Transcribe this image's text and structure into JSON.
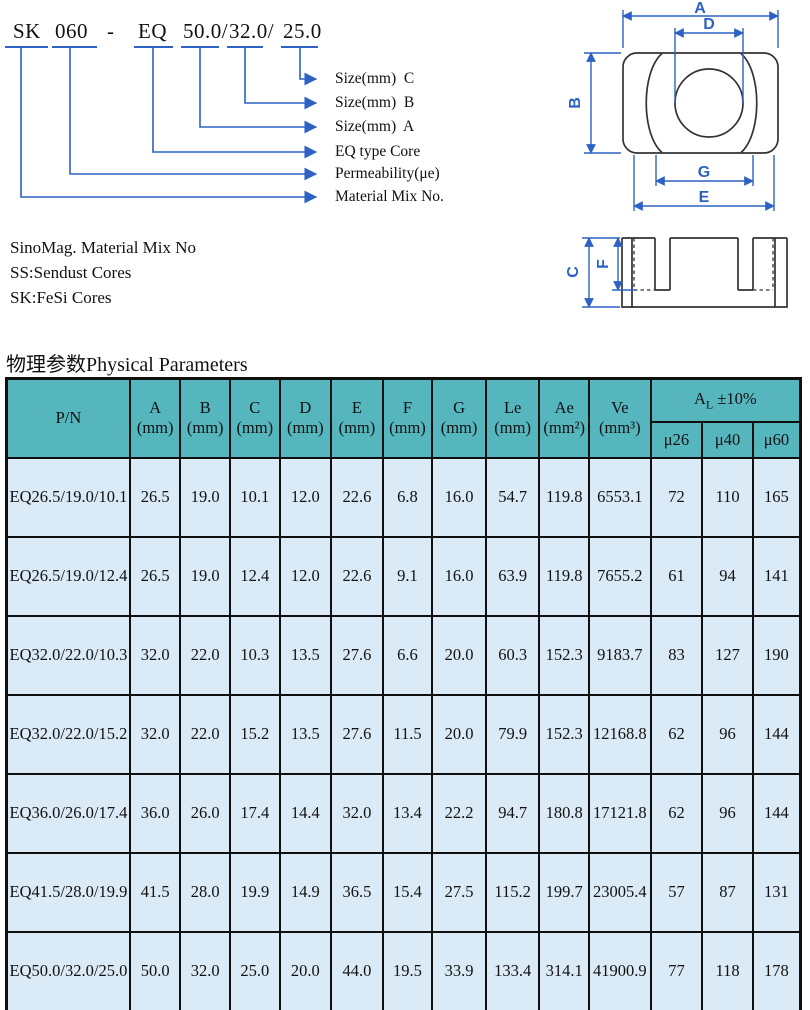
{
  "breakdown": {
    "segments": [
      "SK",
      "060",
      "-",
      "EQ",
      "50.0/",
      "32.0/",
      "25.0"
    ],
    "labels": [
      "Size(mm)  C",
      "Size(mm)  B",
      "Size(mm)  A",
      "EQ type Core",
      "Permeability(μe)",
      "Material Mix No."
    ]
  },
  "notes": [
    "SinoMag. Material Mix No",
    "SS:Sendust Cores",
    "SK:FeSi Cores"
  ],
  "drawing": {
    "labels": {
      "a": "A",
      "d": "D",
      "b": "B",
      "g": "G",
      "e": "E",
      "c": "C",
      "f": "F"
    }
  },
  "section_title": "物理参数Physical Parameters",
  "colors": {
    "accent_blue": "#2d62c4",
    "header_teal": "#55b6be",
    "row_blue": "#daeaf6"
  },
  "table": {
    "col_headers": [
      {
        "label": "P/N",
        "unit": ""
      },
      {
        "label": "A",
        "unit": "(mm)"
      },
      {
        "label": "B",
        "unit": "(mm)"
      },
      {
        "label": "C",
        "unit": "(mm)"
      },
      {
        "label": "D",
        "unit": "(mm)"
      },
      {
        "label": "E",
        "unit": "(mm)"
      },
      {
        "label": "F",
        "unit": "(mm)"
      },
      {
        "label": "G",
        "unit": "(mm)"
      },
      {
        "label": "Le",
        "unit": "(mm)"
      },
      {
        "label": "Ae",
        "unit": "(mm²)"
      },
      {
        "label": "Ve",
        "unit": "(mm³)"
      }
    ],
    "al": {
      "main": "A",
      "sub": "L",
      "tol": " ±10%"
    },
    "sub_headers": [
      "μ26",
      "μ40",
      "μ60"
    ],
    "rows": [
      [
        "EQ26.5/19.0/10.1",
        "26.5",
        "19.0",
        "10.1",
        "12.0",
        "22.6",
        "6.8",
        "16.0",
        "54.7",
        "119.8",
        "6553.1",
        "72",
        "110",
        "165"
      ],
      [
        "EQ26.5/19.0/12.4",
        "26.5",
        "19.0",
        "12.4",
        "12.0",
        "22.6",
        "9.1",
        "16.0",
        "63.9",
        "119.8",
        "7655.2",
        "61",
        "94",
        "141"
      ],
      [
        "EQ32.0/22.0/10.3",
        "32.0",
        "22.0",
        "10.3",
        "13.5",
        "27.6",
        "6.6",
        "20.0",
        "60.3",
        "152.3",
        "9183.7",
        "83",
        "127",
        "190"
      ],
      [
        "EQ32.0/22.0/15.2",
        "32.0",
        "22.0",
        "15.2",
        "13.5",
        "27.6",
        "11.5",
        "20.0",
        "79.9",
        "152.3",
        "12168.8",
        "62",
        "96",
        "144"
      ],
      [
        "EQ36.0/26.0/17.4",
        "36.0",
        "26.0",
        "17.4",
        "14.4",
        "32.0",
        "13.4",
        "22.2",
        "94.7",
        "180.8",
        "17121.8",
        "62",
        "96",
        "144"
      ],
      [
        "EQ41.5/28.0/19.9",
        "41.5",
        "28.0",
        "19.9",
        "14.9",
        "36.5",
        "15.4",
        "27.5",
        "115.2",
        "199.7",
        "23005.4",
        "57",
        "87",
        "131"
      ],
      [
        "EQ50.0/32.0/25.0",
        "50.0",
        "32.0",
        "25.0",
        "20.0",
        "44.0",
        "19.5",
        "33.9",
        "133.4",
        "314.1",
        "41900.9",
        "77",
        "118",
        "178"
      ]
    ]
  }
}
